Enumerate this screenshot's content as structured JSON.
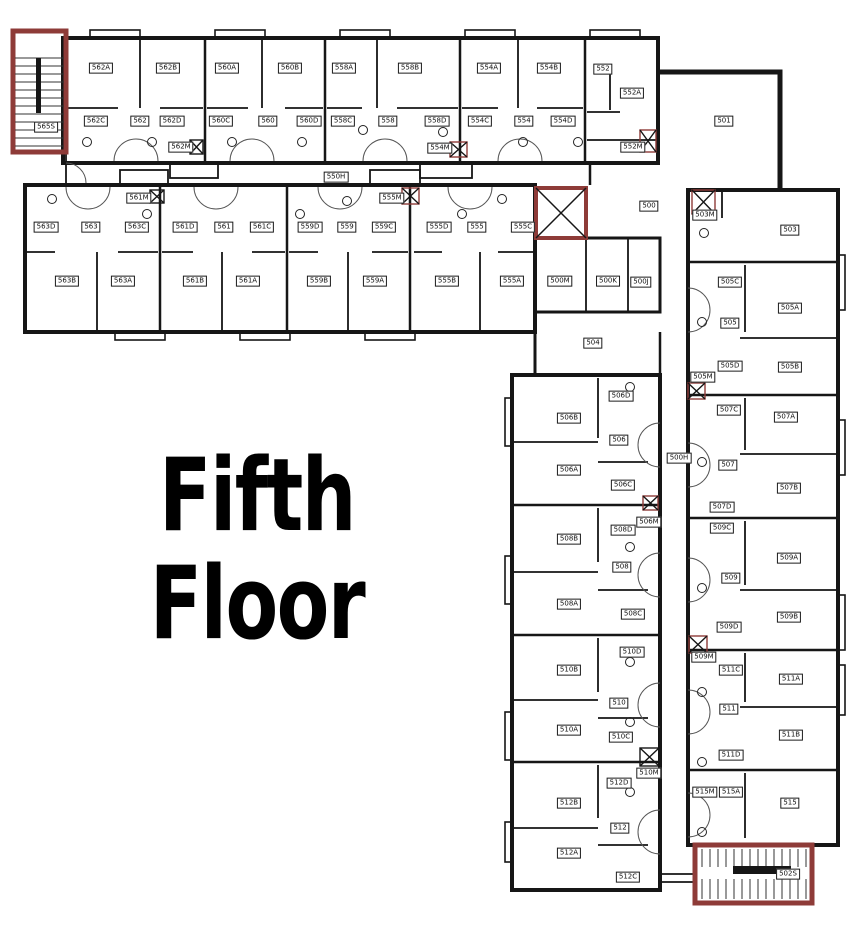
{
  "title": {
    "line1": "Fifth",
    "line2": "Floor"
  },
  "colors": {
    "walls": "#161616",
    "stair_red": "#8e3b38",
    "background": "#ffffff"
  },
  "plan": {
    "rooms": [
      {
        "label": "565S",
        "x": 46,
        "y": 127
      },
      {
        "label": "562A",
        "x": 101,
        "y": 68
      },
      {
        "label": "562B",
        "x": 168,
        "y": 68
      },
      {
        "label": "560A",
        "x": 227,
        "y": 68
      },
      {
        "label": "560B",
        "x": 290,
        "y": 68
      },
      {
        "label": "558A",
        "x": 344,
        "y": 68
      },
      {
        "label": "558B",
        "x": 410,
        "y": 68
      },
      {
        "label": "554A",
        "x": 489,
        "y": 68
      },
      {
        "label": "554B",
        "x": 549,
        "y": 68
      },
      {
        "label": "552",
        "x": 603,
        "y": 69
      },
      {
        "label": "562C",
        "x": 96,
        "y": 121
      },
      {
        "label": "562",
        "x": 140,
        "y": 121
      },
      {
        "label": "562D",
        "x": 172,
        "y": 121
      },
      {
        "label": "560C",
        "x": 221,
        "y": 121
      },
      {
        "label": "560",
        "x": 268,
        "y": 121
      },
      {
        "label": "560D",
        "x": 309,
        "y": 121
      },
      {
        "label": "558C",
        "x": 343,
        "y": 121
      },
      {
        "label": "558",
        "x": 388,
        "y": 121
      },
      {
        "label": "558D",
        "x": 437,
        "y": 121
      },
      {
        "label": "554C",
        "x": 480,
        "y": 121
      },
      {
        "label": "554",
        "x": 524,
        "y": 121
      },
      {
        "label": "554D",
        "x": 563,
        "y": 121
      },
      {
        "label": "552A",
        "x": 632,
        "y": 93
      },
      {
        "label": "552M",
        "x": 633,
        "y": 147
      },
      {
        "label": "562M",
        "x": 181,
        "y": 147
      },
      {
        "label": "554M",
        "x": 440,
        "y": 148
      },
      {
        "label": "550H",
        "x": 336,
        "y": 177
      },
      {
        "label": "563D",
        "x": 46,
        "y": 227
      },
      {
        "label": "563",
        "x": 91,
        "y": 227
      },
      {
        "label": "563C",
        "x": 137,
        "y": 227
      },
      {
        "label": "561D",
        "x": 185,
        "y": 227
      },
      {
        "label": "561",
        "x": 224,
        "y": 227
      },
      {
        "label": "561C",
        "x": 262,
        "y": 227
      },
      {
        "label": "559D",
        "x": 310,
        "y": 227
      },
      {
        "label": "559",
        "x": 347,
        "y": 227
      },
      {
        "label": "559C",
        "x": 384,
        "y": 227
      },
      {
        "label": "555D",
        "x": 439,
        "y": 227
      },
      {
        "label": "555",
        "x": 477,
        "y": 227
      },
      {
        "label": "555C",
        "x": 523,
        "y": 227
      },
      {
        "label": "561M",
        "x": 139,
        "y": 198
      },
      {
        "label": "555M",
        "x": 392,
        "y": 198
      },
      {
        "label": "563B",
        "x": 67,
        "y": 281
      },
      {
        "label": "563A",
        "x": 123,
        "y": 281
      },
      {
        "label": "561B",
        "x": 195,
        "y": 281
      },
      {
        "label": "561A",
        "x": 248,
        "y": 281
      },
      {
        "label": "559B",
        "x": 319,
        "y": 281
      },
      {
        "label": "559A",
        "x": 375,
        "y": 281
      },
      {
        "label": "555B",
        "x": 447,
        "y": 281
      },
      {
        "label": "555A",
        "x": 512,
        "y": 281
      },
      {
        "label": "500M",
        "x": 560,
        "y": 281
      },
      {
        "label": "500K",
        "x": 608,
        "y": 281
      },
      {
        "label": "500J",
        "x": 641,
        "y": 282
      },
      {
        "label": "501",
        "x": 724,
        "y": 121
      },
      {
        "label": "500",
        "x": 649,
        "y": 206
      },
      {
        "label": "504",
        "x": 593,
        "y": 343
      },
      {
        "label": "500H",
        "x": 679,
        "y": 458
      },
      {
        "label": "503M",
        "x": 705,
        "y": 215
      },
      {
        "label": "503",
        "x": 790,
        "y": 230
      },
      {
        "label": "505C",
        "x": 730,
        "y": 282
      },
      {
        "label": "505A",
        "x": 790,
        "y": 308
      },
      {
        "label": "505",
        "x": 730,
        "y": 323
      },
      {
        "label": "505D",
        "x": 730,
        "y": 366
      },
      {
        "label": "505B",
        "x": 790,
        "y": 367
      },
      {
        "label": "505M",
        "x": 703,
        "y": 377
      },
      {
        "label": "506D",
        "x": 621,
        "y": 396
      },
      {
        "label": "506B",
        "x": 569,
        "y": 418
      },
      {
        "label": "506",
        "x": 619,
        "y": 440
      },
      {
        "label": "506A",
        "x": 569,
        "y": 470
      },
      {
        "label": "506C",
        "x": 623,
        "y": 485
      },
      {
        "label": "506M",
        "x": 649,
        "y": 522
      },
      {
        "label": "507C",
        "x": 729,
        "y": 410
      },
      {
        "label": "507A",
        "x": 786,
        "y": 417
      },
      {
        "label": "507",
        "x": 728,
        "y": 465
      },
      {
        "label": "507B",
        "x": 789,
        "y": 488
      },
      {
        "label": "507D",
        "x": 722,
        "y": 507
      },
      {
        "label": "508D",
        "x": 623,
        "y": 530
      },
      {
        "label": "508B",
        "x": 569,
        "y": 539
      },
      {
        "label": "508",
        "x": 622,
        "y": 567
      },
      {
        "label": "508A",
        "x": 569,
        "y": 604
      },
      {
        "label": "508C",
        "x": 633,
        "y": 614
      },
      {
        "label": "509C",
        "x": 722,
        "y": 528
      },
      {
        "label": "509A",
        "x": 789,
        "y": 558
      },
      {
        "label": "509",
        "x": 731,
        "y": 578
      },
      {
        "label": "509B",
        "x": 789,
        "y": 617
      },
      {
        "label": "509D",
        "x": 729,
        "y": 627
      },
      {
        "label": "509M",
        "x": 704,
        "y": 657
      },
      {
        "label": "510D",
        "x": 632,
        "y": 652
      },
      {
        "label": "510B",
        "x": 569,
        "y": 670
      },
      {
        "label": "510",
        "x": 619,
        "y": 703
      },
      {
        "label": "510A",
        "x": 569,
        "y": 730
      },
      {
        "label": "510C",
        "x": 621,
        "y": 737
      },
      {
        "label": "510M",
        "x": 649,
        "y": 773
      },
      {
        "label": "511C",
        "x": 731,
        "y": 670
      },
      {
        "label": "511A",
        "x": 791,
        "y": 679
      },
      {
        "label": "511",
        "x": 729,
        "y": 709
      },
      {
        "label": "511B",
        "x": 791,
        "y": 735
      },
      {
        "label": "511D",
        "x": 731,
        "y": 755
      },
      {
        "label": "512D",
        "x": 619,
        "y": 783
      },
      {
        "label": "512B",
        "x": 569,
        "y": 803
      },
      {
        "label": "512",
        "x": 620,
        "y": 828
      },
      {
        "label": "512A",
        "x": 569,
        "y": 853
      },
      {
        "label": "512C",
        "x": 628,
        "y": 877
      },
      {
        "label": "515M",
        "x": 705,
        "y": 792
      },
      {
        "label": "515A",
        "x": 731,
        "y": 792
      },
      {
        "label": "515",
        "x": 790,
        "y": 803
      },
      {
        "label": "502S",
        "x": 788,
        "y": 874
      }
    ]
  }
}
